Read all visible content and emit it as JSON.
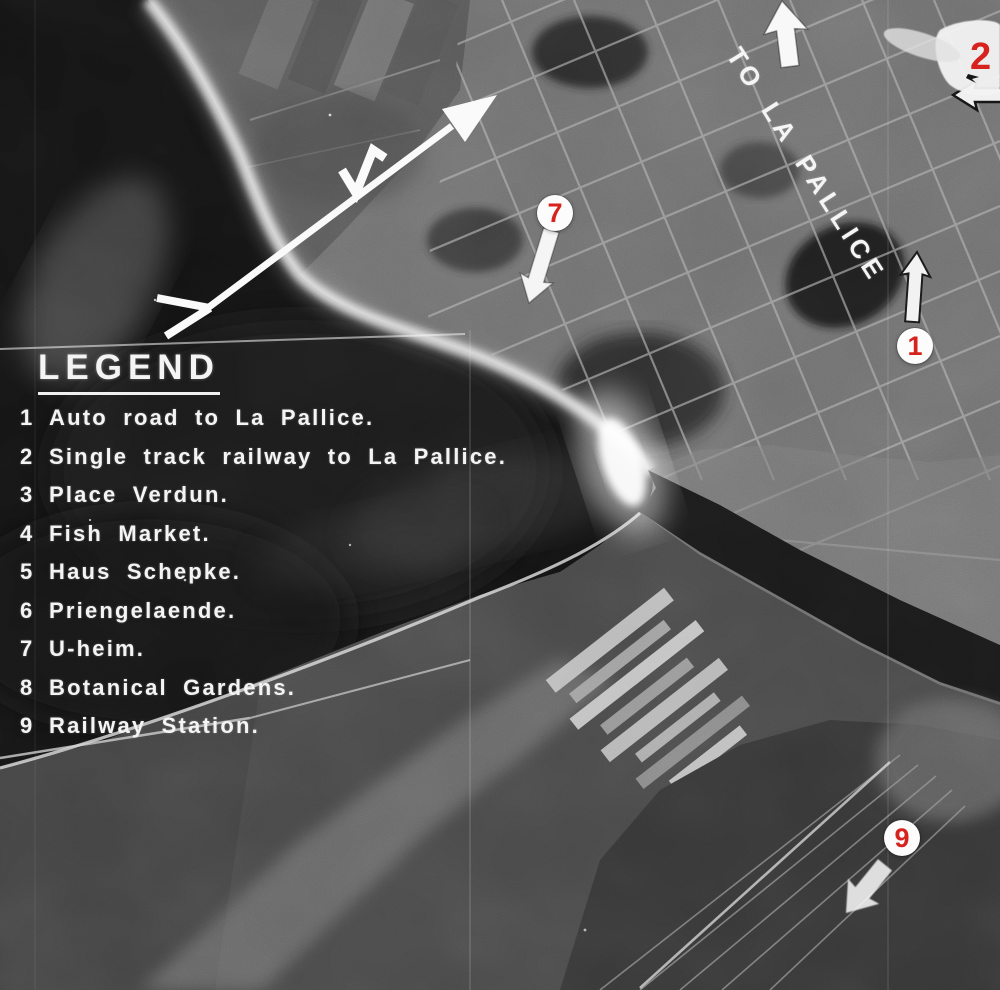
{
  "meta": {
    "description": "Annotated aerial reconnaissance photograph of La Rochelle harbour with numbered targets",
    "figure_type": "annotated-aerial-photograph"
  },
  "legend": {
    "title": "LEGEND",
    "items": [
      {
        "num": "1",
        "label": "Auto road to La Pallice."
      },
      {
        "num": "2",
        "label": "Single track railway to La Pallice."
      },
      {
        "num": "3",
        "label": "Place Verdun."
      },
      {
        "num": "4",
        "label": "Fish Market."
      },
      {
        "num": "5",
        "label": "Haus Schepke."
      },
      {
        "num": "6",
        "label": "Priengelaende."
      },
      {
        "num": "7",
        "label": "U-heim."
      },
      {
        "num": "8",
        "label": "Botanical Gardens."
      },
      {
        "num": "9",
        "label": "Railway Station."
      }
    ]
  },
  "markers": {
    "m1": {
      "label": "1"
    },
    "m2": {
      "label": "2"
    },
    "m7": {
      "label": "7"
    },
    "m9": {
      "label": "9"
    }
  },
  "annotations": {
    "route_label": "TO LA PALLICE",
    "arrow_icons": [
      "up-arrow-icon",
      "down-left-arrow-icon",
      "left-arrow-icon",
      "long-route-arrow-icon",
      "zigzag-mark-icon"
    ]
  },
  "colors": {
    "marker_red": "#d6231e",
    "annotation_white": "#f5f5f5",
    "water_black": "#131313",
    "city_gray": "#6e6e6e"
  }
}
